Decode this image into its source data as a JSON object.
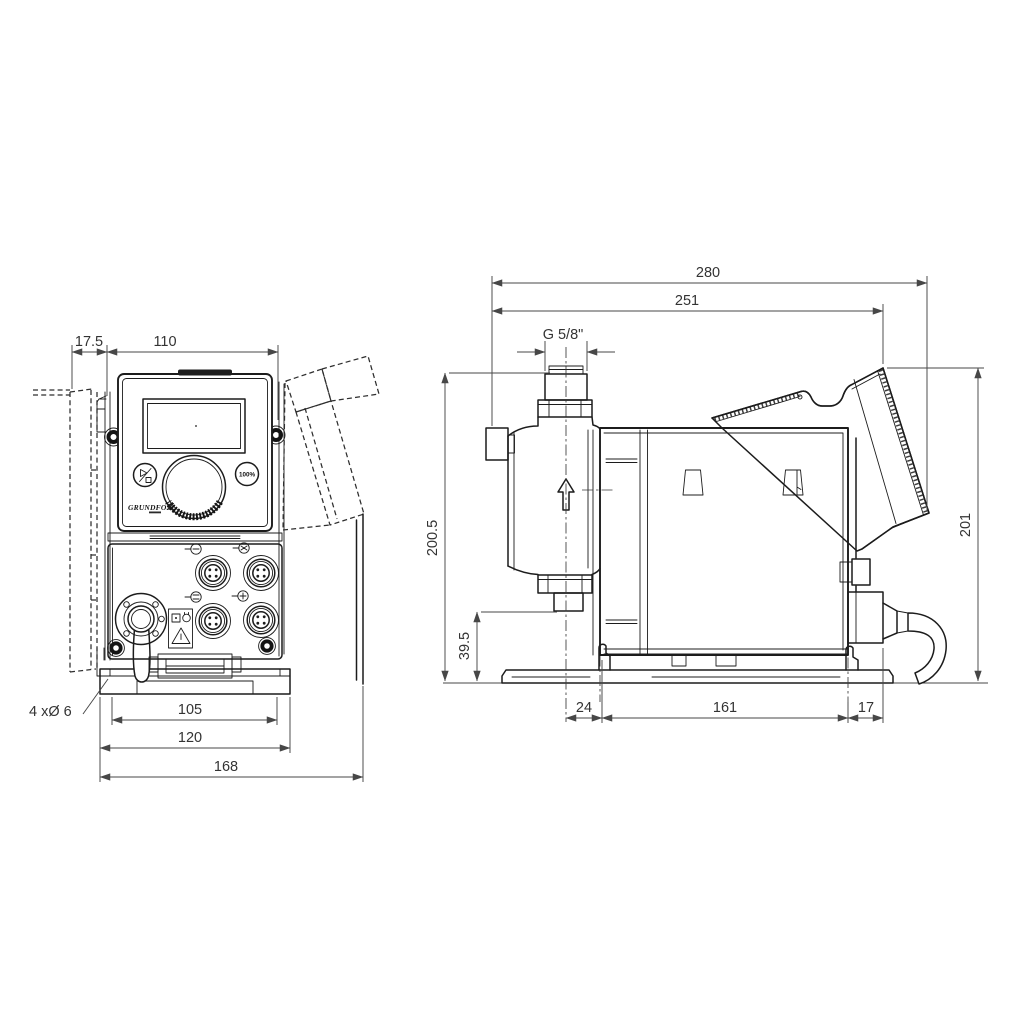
{
  "front_view": {
    "dims": {
      "offset_top": "17.5",
      "panel_width": "110",
      "mount_holes_note": "4 xØ 6",
      "hole_spacing": "105",
      "bracket_width": "120",
      "overall_width": "168"
    },
    "panel": {
      "brand": "GRUNDFOS",
      "button_100_label": "100%"
    }
  },
  "side_view": {
    "dims": {
      "overall_depth": "280",
      "depth_to_panel_top": "251",
      "connection_thread": "G 5/8\"",
      "overall_height": "200.5",
      "connection_height": "39.5",
      "panel_top_height": "201",
      "head_center_offset": "24",
      "housing_length": "161",
      "rear_offset": "17"
    }
  }
}
